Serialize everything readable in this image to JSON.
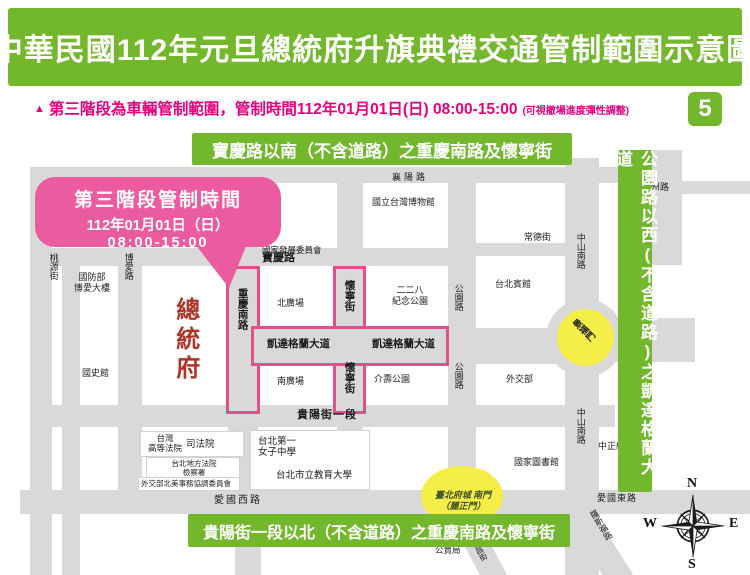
{
  "header": {
    "title": "中華民國112年元旦總統府升旗典禮交通管制範圍示意圖"
  },
  "notice": {
    "marker": "▲",
    "text": "第三階段為車輛管制範圍，管制時間112年01月01日(日) 08:00-15:00",
    "note": "(可視撤場進度彈性調整)",
    "page_badge": "5"
  },
  "callout": {
    "title": "第三階段管制時間",
    "date": "112年01月01日（日）",
    "time": "08:00-15:00"
  },
  "banners": {
    "top": "寶慶路以南（不含道路）之重慶南路及懷寧街",
    "right": "公園路以西(不含道路)之凱達格蘭大道",
    "bottom": "貴陽街一段以北（不含道路）之重慶南路及懷寧街"
  },
  "map": {
    "streets": {
      "xiangyang": "襄陽路",
      "baoqing": "寶慶路",
      "changde": "常德街",
      "xuzhou": "徐州路",
      "kaidagelan_w": "凱達格蘭大道",
      "kaidagelan_e": "凱達格蘭大道",
      "guiyang": "貴陽街一段",
      "aiguo_w": "愛國西路",
      "aiguo_e": "愛國東路",
      "taoyuan": "桃源街",
      "boai": "博愛路",
      "chongqing": "重慶南路",
      "huaining_n": "懷寧街",
      "huaining_s": "懷寧街",
      "gongyuan_n": "公園路",
      "gongyuan_s": "公園路",
      "zhongshan_n": "中山南路",
      "zhongshan_s": "中山南路",
      "nanchang": "南昌街",
      "luosifu": "羅斯福路"
    },
    "places": {
      "guofangbu": "國防部\n博愛大樓",
      "guoshiguan": "國史館",
      "zongtongfu": "總統府",
      "fazhanwei": "國家發展委員會",
      "bowuguan": "國立台灣博物館",
      "ereba": "二二八\n紀念公園",
      "beiguangchang": "北廣場",
      "nanguangchang": "南廣場",
      "jieshou": "介壽公園",
      "taibeibinguan": "台北賓館",
      "waijiaobu": "外交部",
      "sifayuan": "司法院",
      "gaofa": "台灣\n高等法院",
      "difa": "台北地方法院\n檢察署",
      "beimei": "外交部北美事務協調委員會",
      "beiyinu": "台北第一\n女子中學",
      "jiaoyuda": "台北市立教育大學",
      "tushuguan": "國家圖書館",
      "gongmaiju": "公賣局",
      "zhongzheng": "中正紀念堂"
    },
    "landmarks": {
      "jingfumen": "景福門",
      "nanmen": "臺北府城 南門\n（麗正門）"
    },
    "compass": {
      "n": "N",
      "s": "S",
      "e": "E",
      "w": "W"
    }
  },
  "colors": {
    "green": "#73b72c",
    "notice_pink": "#e5007d",
    "callout_pink": "#ea5c9f",
    "control_outline_pink": "#e14f8d",
    "road_gray": "#d9d9d9",
    "landmark_yellow": "#f6ee48",
    "president_red": "#ad3428"
  }
}
